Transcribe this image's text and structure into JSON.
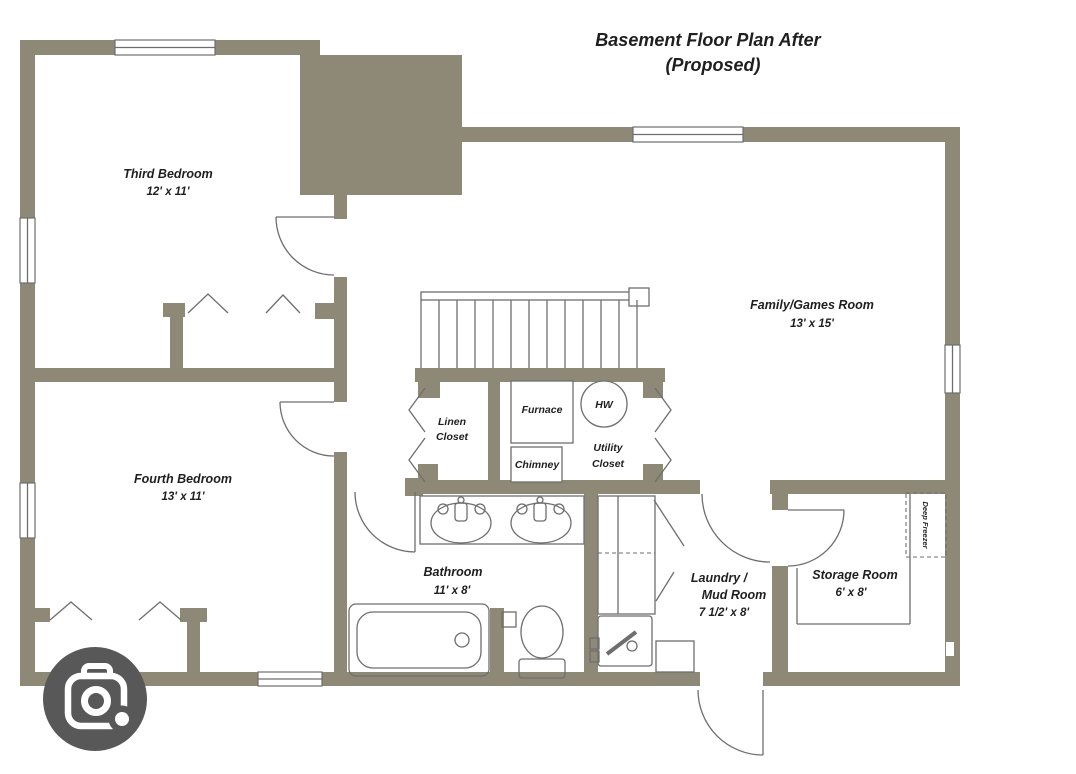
{
  "title": {
    "line1": "Basement Floor Plan After",
    "line2": "(Proposed)"
  },
  "rooms": {
    "third_bedroom": {
      "name": "Third Bedroom",
      "dims": "12' x 11'"
    },
    "fourth_bedroom": {
      "name": "Fourth Bedroom",
      "dims": "13' x 11'"
    },
    "family_room": {
      "name": "Family/Games Room",
      "dims": "13' x 15'"
    },
    "bathroom": {
      "name": "Bathroom",
      "dims": "11' x 8'"
    },
    "laundry": {
      "name_line1": "Laundry /",
      "name_line2": "Mud Room",
      "dims": "7 1/2' x 8'"
    },
    "storage": {
      "name": "Storage Room",
      "dims": "6' x 8'"
    },
    "linen_closet": {
      "line1": "Linen",
      "line2": "Closet"
    },
    "utility_closet": {
      "line1": "Utility",
      "line2": "Closet"
    }
  },
  "equipment": {
    "furnace": "Furnace",
    "chimney": "Chimney",
    "water_heater": "HW",
    "deep_freezer": "Deep Freezer"
  },
  "colors": {
    "wall": "#8e8976",
    "line": "#6e6e6e",
    "text": "#1f1f1f",
    "background": "#ffffff",
    "lens_button": "#585858"
  }
}
